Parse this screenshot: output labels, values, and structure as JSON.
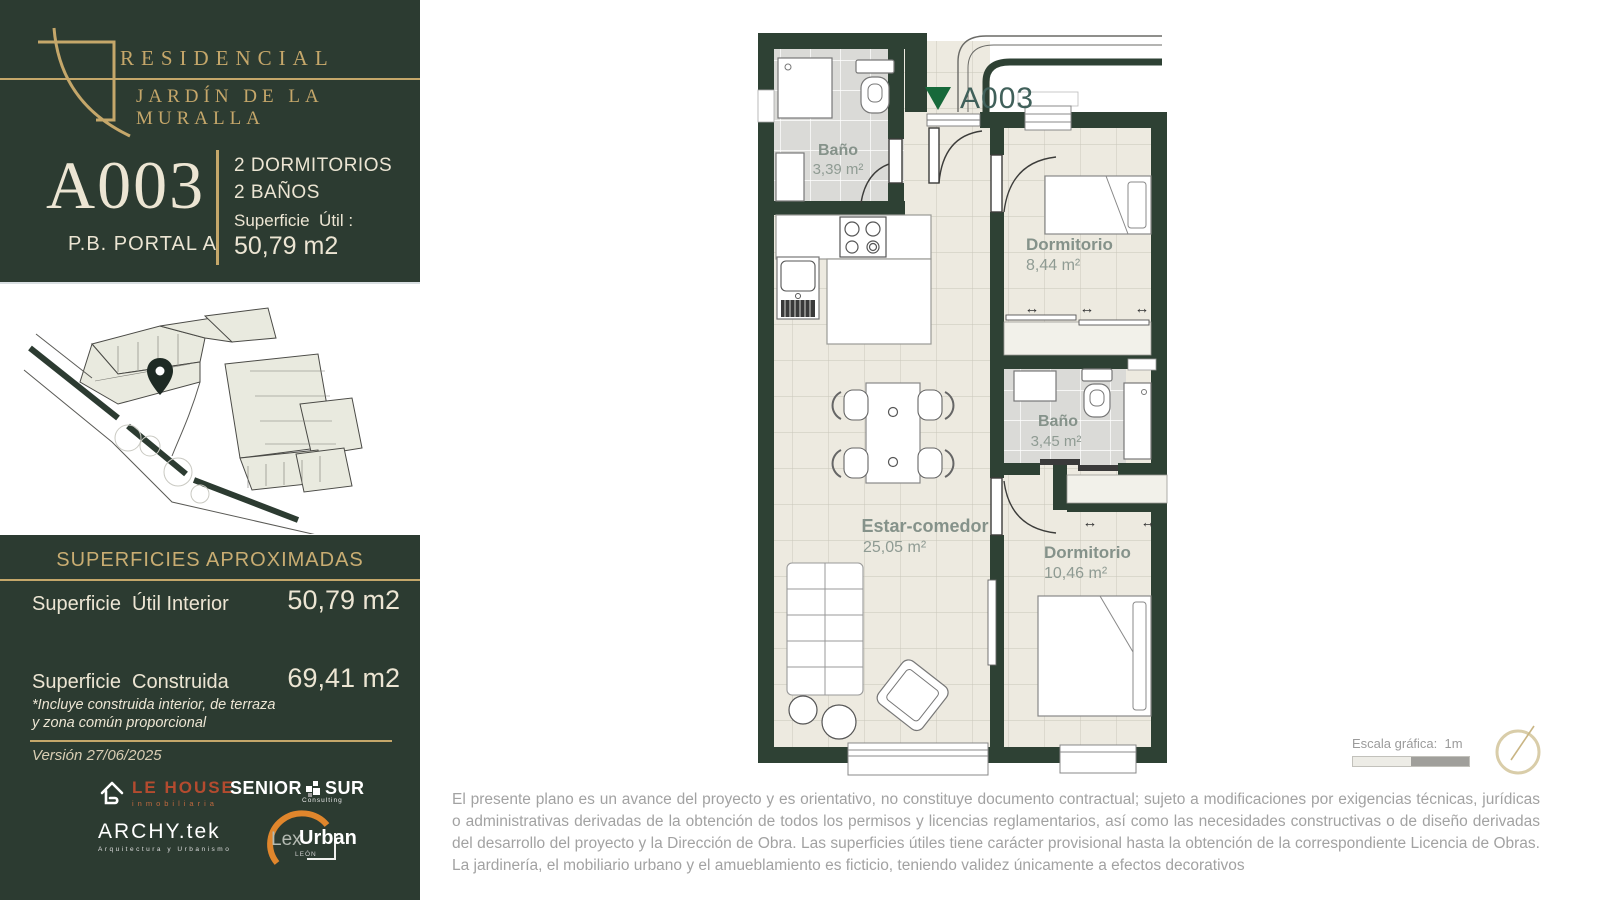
{
  "brand": {
    "name_line1": "RESIDENCIAL",
    "name_line2": "JARDÍN DE LA MURALLA"
  },
  "unit_card": {
    "code": "A003",
    "portal": "P.B. PORTAL A",
    "feature1": "2 DORMITORIOS",
    "feature2": "2 BAÑOS",
    "surface_label": "Superficie  Útil :",
    "surface_value": "50,79 m2"
  },
  "surfaces_panel": {
    "title": "SUPERFICIES APROXIMADAS",
    "row1_label": "Superficie  Útil Interior",
    "row1_value": "50,79 m2",
    "row2_label": "Superficie  Construida",
    "row2_value": "69,41 m2",
    "note_line1": "*Incluye construida interior, de terraza",
    "note_line2": "y zona común proporcional",
    "version": "Versión 27/06/2025"
  },
  "partner_logos": {
    "lehouse_name": "LE HOUSE",
    "lehouse_sub": "inmobiliaria",
    "seniorsur_left": "SENIOR",
    "seniorsur_right": "SUR",
    "seniorsur_sub": "Consulting",
    "archytek_name": "ARCHY.tek",
    "archytek_sub": "Arquitectura y Urbanismo",
    "lexurban_lex": "Lex",
    "lexurban_urban": "Urban",
    "lexurban_sub": "LEÓN"
  },
  "floorplan": {
    "marker_label": "A003",
    "rooms": [
      {
        "name": "Baño",
        "area": "3,39 m²"
      },
      {
        "name": "Dormitorio",
        "area": "8,44 m²"
      },
      {
        "name": "Baño",
        "area": "3,45 m²"
      },
      {
        "name": "Estar-comedor",
        "area": "25,05 m²"
      },
      {
        "name": "Dormitorio",
        "area": "10,46 m²"
      }
    ],
    "window_arrow": "↔"
  },
  "scale_bar": {
    "label": "Escala gráfica:  1m"
  },
  "disclaimer": "El presente plano es un avance del proyecto y es orientativo, no constituye documento contractual; sujeto a modificaciones por exigencias técnicas, jurídicas o administrativas derivadas de la obtención de todos los permisos y licencias reglamentarios, así como las necesidades constructivas o de diseño derivadas del desarrollo del proyecto y la Dirección de Obra. Las superficies útiles tiene carácter provisional hasta la obtención de la correspondiente Licencia de Obras. La jardinería, el mobiliario urbano y el amueblamiento es ficticio, teniendo validez únicamente a efectos decorativos",
  "colors": {
    "panel_green": "#2c3b31",
    "wall_green": "#2e4134",
    "gold": "#c5a76a",
    "cream": "#ece5d3",
    "marker_green": "#17693a",
    "room_label_gray": "#85928a",
    "floor_beige": "#edeae0",
    "bath_gray": "#dadad7",
    "lehouse_orange": "#b44b2f",
    "lexurban_orange": "#e0862c",
    "disclaimer_gray": "#a2a2a2"
  }
}
